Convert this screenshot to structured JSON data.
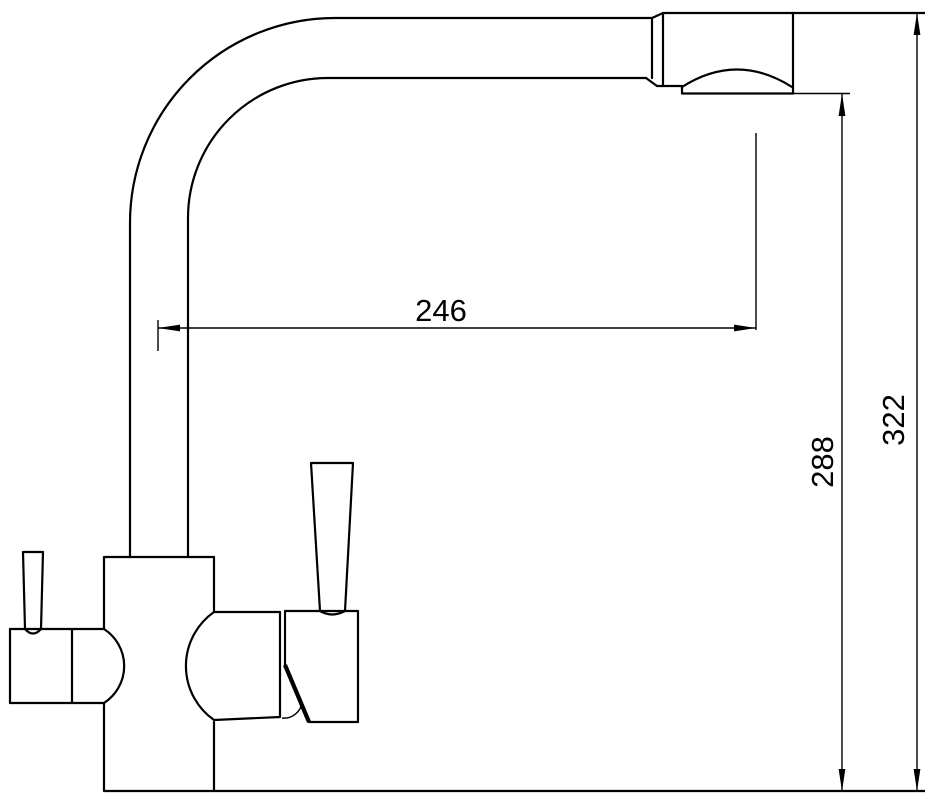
{
  "canvas": {
    "background": "#ffffff",
    "line_color": "#000000"
  },
  "drawing": {
    "subject": "kitchen-faucet-dimension-drawing"
  },
  "dimensions": {
    "spout_reach": {
      "value": "246",
      "orientation": "horizontal"
    },
    "outlet_height": {
      "value": "288",
      "orientation": "vertical"
    },
    "overall_height": {
      "value": "322",
      "orientation": "vertical"
    }
  }
}
